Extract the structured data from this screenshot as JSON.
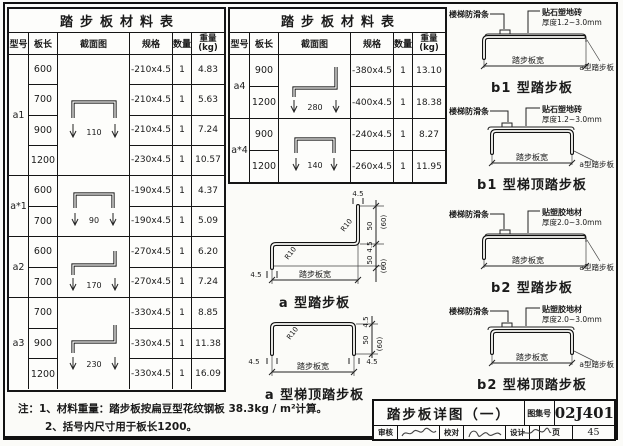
{
  "left_table": {
    "title": "踏步板材料表",
    "head": {
      "model": "型号",
      "len": "板长",
      "sec": "截面图",
      "spec": "规格",
      "qty": "数量",
      "wt": "重量",
      "wt_unit": "(kg)"
    },
    "groups": [
      {
        "model": "a1",
        "dim": "110",
        "rows": [
          {
            "len": "600",
            "spec": "-210x4.5",
            "qty": "1",
            "wt": "4.83"
          },
          {
            "len": "700",
            "spec": "-210x4.5",
            "qty": "1",
            "wt": "5.63"
          },
          {
            "len": "900",
            "spec": "-210x4.5",
            "qty": "1",
            "wt": "7.24"
          },
          {
            "len": "1200",
            "spec": "-230x4.5",
            "qty": "1",
            "wt": "10.57"
          }
        ]
      },
      {
        "model": "a*1",
        "dim": "90",
        "rows": [
          {
            "len": "600",
            "spec": "-190x4.5",
            "qty": "1",
            "wt": "4.37"
          },
          {
            "len": "700",
            "spec": "-190x4.5",
            "qty": "1",
            "wt": "5.09"
          }
        ]
      },
      {
        "model": "a2",
        "dim": "170",
        "rows": [
          {
            "len": "600",
            "spec": "-270x4.5",
            "qty": "1",
            "wt": "6.20"
          },
          {
            "len": "700",
            "spec": "-270x4.5",
            "qty": "1",
            "wt": "7.24"
          }
        ]
      },
      {
        "model": "a3",
        "dim": "230",
        "rows": [
          {
            "len": "700",
            "spec": "-330x4.5",
            "qty": "1",
            "wt": "8.85"
          },
          {
            "len": "900",
            "spec": "-330x4.5",
            "qty": "1",
            "wt": "11.38"
          },
          {
            "len": "1200",
            "spec": "-330x4.5",
            "qty": "1",
            "wt": "16.09"
          }
        ]
      }
    ]
  },
  "middle_table": {
    "title": "踏步板材料表",
    "head": {
      "model": "型号",
      "len": "板长",
      "sec": "截面图",
      "spec": "规格",
      "qty": "数量",
      "wt": "重量",
      "wt_unit": "(kg)"
    },
    "groups": [
      {
        "model": "a4",
        "dim": "280",
        "rows": [
          {
            "len": "900",
            "spec": "-380x4.5",
            "qty": "1",
            "wt": "13.10"
          },
          {
            "len": "1200",
            "spec": "-400x4.5",
            "qty": "1",
            "wt": "18.38"
          }
        ]
      },
      {
        "model": "a*4",
        "dim": "140",
        "rows": [
          {
            "len": "900",
            "spec": "-240x4.5",
            "qty": "1",
            "wt": "8.27"
          },
          {
            "len": "1200",
            "spec": "-260x4.5",
            "qty": "1",
            "wt": "11.95"
          }
        ]
      }
    ]
  },
  "diagram_a": {
    "caption": "a 型踏步板",
    "width_label": "踏步板宽",
    "radius": "R10",
    "top_thk": "4.5",
    "left_thk": "4.5",
    "r1": "(60)",
    "r2": "50",
    "r3": "4.5",
    "r4": "50",
    "r5": "(60)"
  },
  "diagram_a_top": {
    "caption": "a 型梯顶踏步板",
    "width_label": "踏步板宽",
    "radius": "R10",
    "left_thk": "4.5",
    "right_thk": "4.5",
    "r1": "4.5",
    "r2": "50",
    "r3": "(60)"
  },
  "b_diagrams": [
    {
      "caption": "b1 型踏步板",
      "strip": "楼梯防滑条",
      "finish1": "贴石塑地砖",
      "finish2": "厚度1.2~3.0mm",
      "width_label": "踏步板宽",
      "callout": "a型踏步板"
    },
    {
      "caption": "b1 型梯顶踏步板",
      "strip": "楼梯防滑条",
      "finish1": "贴石塑地砖",
      "finish2": "厚度1.2~3.0mm",
      "width_label": "踏步板宽",
      "callout": "a型踏步板"
    },
    {
      "caption": "b2 型踏步板",
      "strip": "楼梯防滑条",
      "finish1": "贴塑胶地材",
      "finish2": "厚度2.0~3.0mm",
      "width_label": "踏步板宽",
      "callout": "a型踏步板"
    },
    {
      "caption": "b2 型梯顶踏步板",
      "strip": "楼梯防滑条",
      "finish1": "贴塑胶地材",
      "finish2": "厚度2.0~3.0mm",
      "width_label": "踏步板宽",
      "callout": "a型踏步板"
    }
  ],
  "notes": {
    "line1": "注：1、材料重量：踏步板按扁豆型花纹钢板 38.3kg / m²计算。",
    "line2": "2、括号内尺寸用于板长1200。"
  },
  "title_block": {
    "drawing_title": "踏步板详图（一）",
    "atlas_label": "图集号",
    "atlas_no": "02J401",
    "review": "审核",
    "proof": "校对",
    "design": "设计",
    "page_label": "页",
    "page_no": "45"
  }
}
